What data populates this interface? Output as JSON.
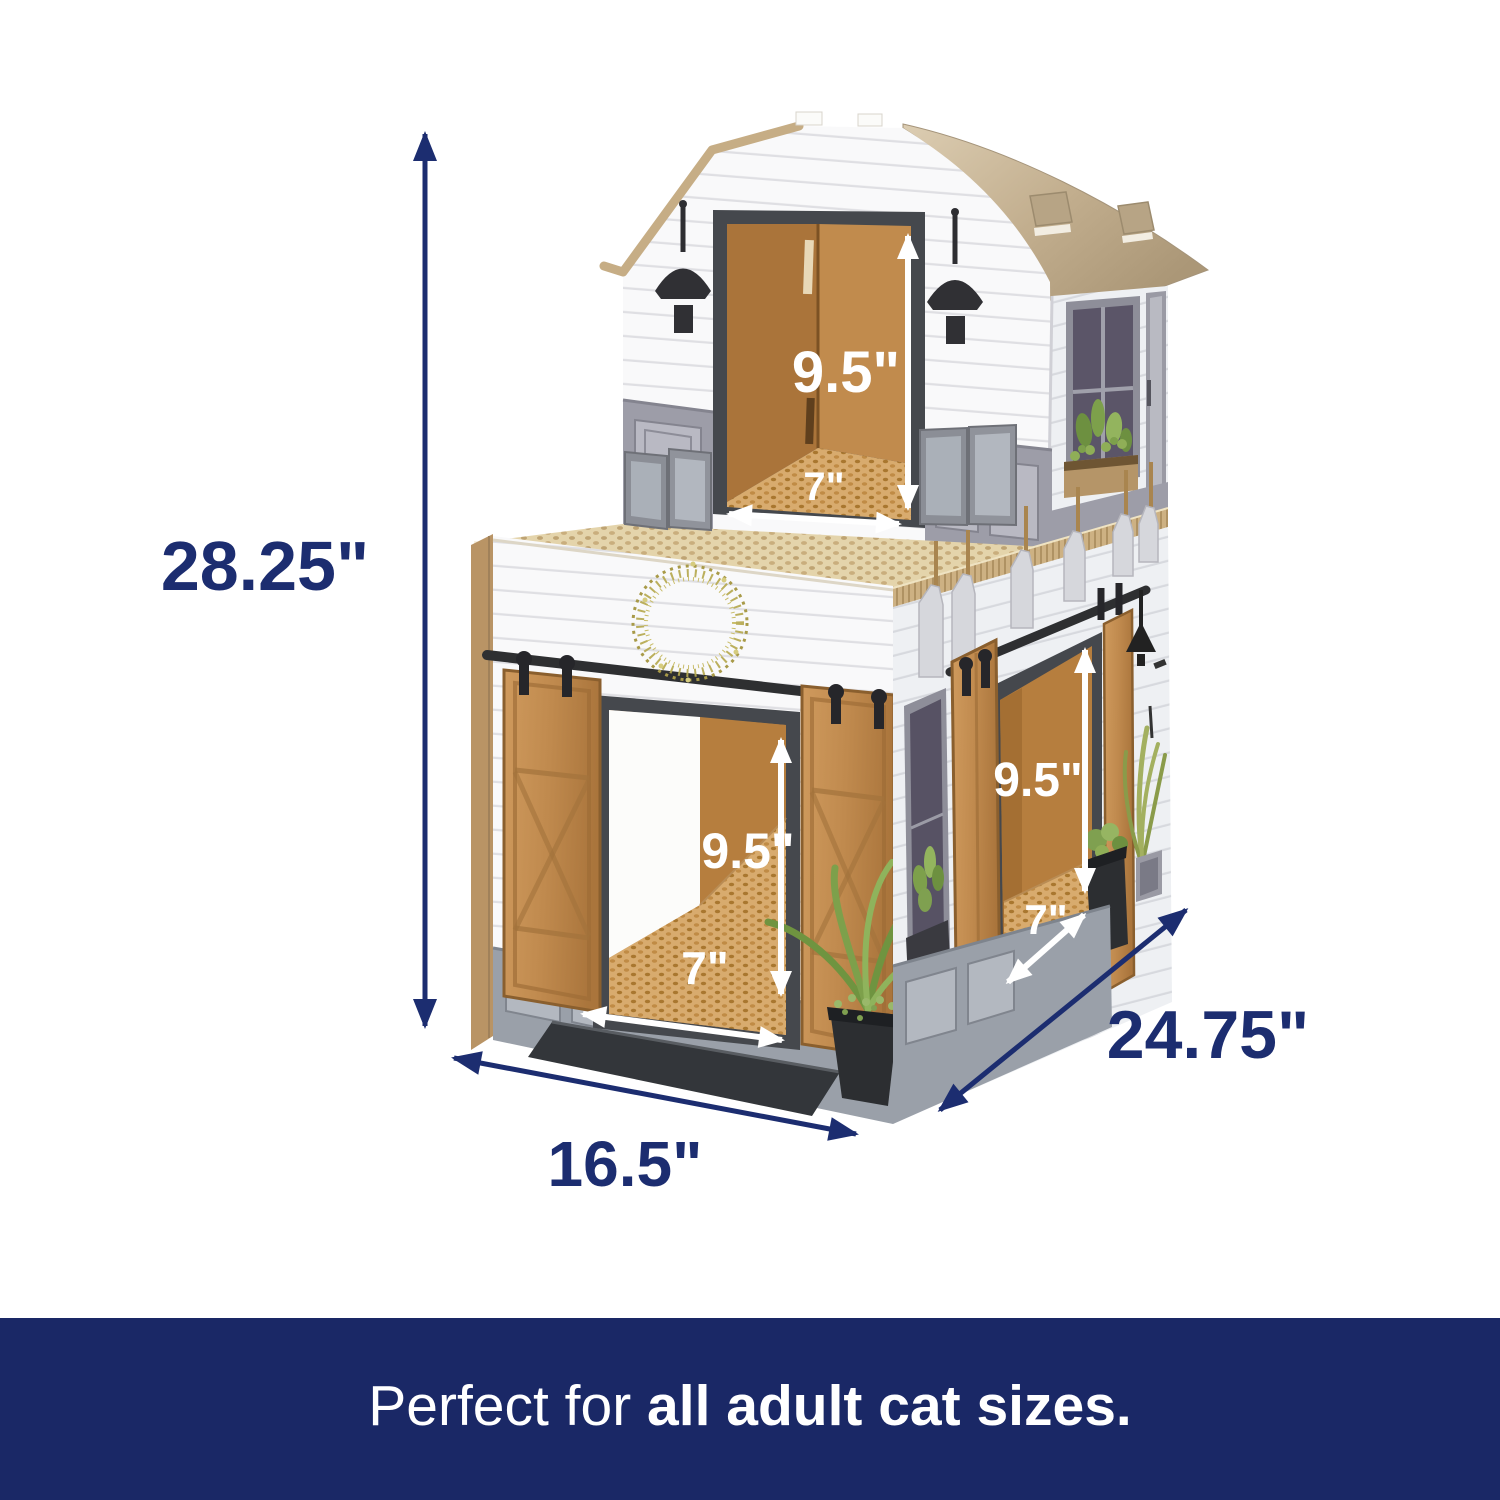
{
  "banner": {
    "prefix": "Perfect for ",
    "bold": "all adult cat sizes.",
    "background_color": "#1a2866",
    "text_color": "#ffffff"
  },
  "dimensions": {
    "label_color": "#1c2d70",
    "overall_height": "28.25\"",
    "base_depth": "16.5\"",
    "base_width": "24.75\"",
    "loft_door": {
      "height": "9.5\"",
      "width": "7\""
    },
    "front_door": {
      "height": "9.5\"",
      "width": "7\""
    },
    "side_door": {
      "height": "9.5\"",
      "width": "7\""
    }
  },
  "illustration": {
    "subject": "two-story cardboard farmhouse barn cat house with scratcher floors",
    "elements": [
      "barn-roof",
      "loft-doorway",
      "barn-light-icon",
      "scratcher-deck",
      "sliding-barn-doors",
      "wreath-decoration",
      "front-doorway",
      "side-doorway",
      "pendant-light-icon",
      "potted-plants",
      "hanging-tool-cutouts"
    ],
    "colors": {
      "roof_cardboard": "#c4b094",
      "cardboard_interior": "#b67e3e",
      "scratcher_pad": "#e4d4ab",
      "wall_white": "#f9f9fa",
      "trim_charcoal": "#45484d",
      "wainscot_gray": "#9d9da8",
      "barn_door_wood": "#c08a4e",
      "hardware_black": "#2e2f31",
      "plant_green": "#7da04b",
      "wreath_gold": "#b5a84f"
    }
  }
}
